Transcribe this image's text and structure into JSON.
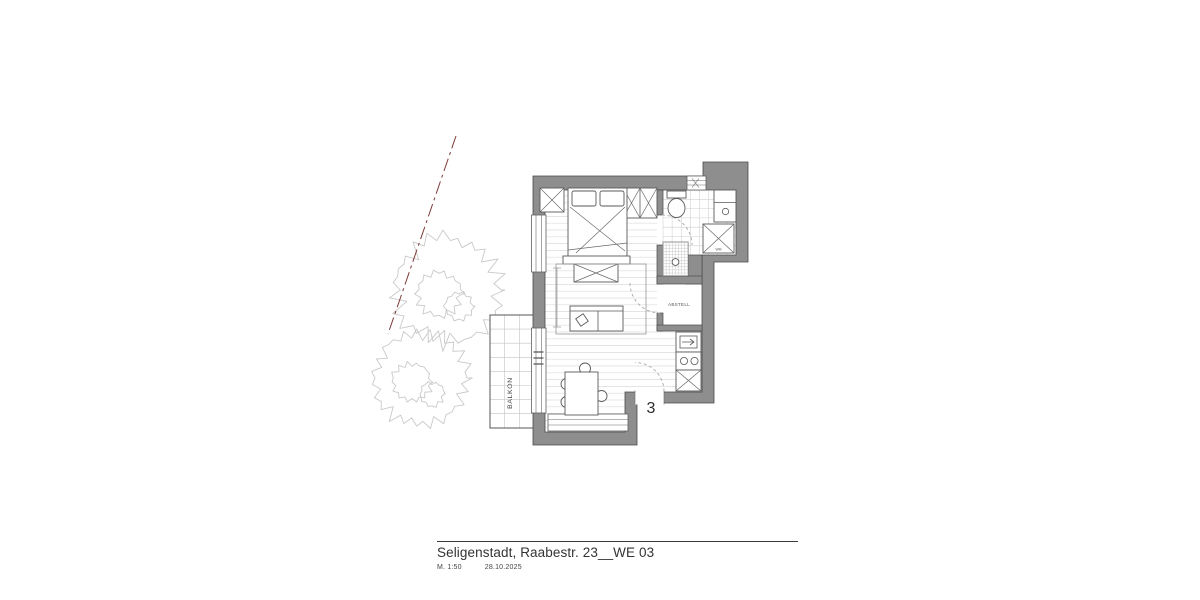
{
  "title_block": {
    "project": "Seligenstadt, Raabestr. 23__WE 03",
    "scale": "M. 1:50",
    "date": "28.10.2025"
  },
  "plan": {
    "apartment_number": "3",
    "rooms": {
      "balcony_label": "BALKON",
      "storage_label": "ABSTELL"
    },
    "fixtures": {
      "washing_machine_label": "WM"
    },
    "colors": {
      "wall_fill": "#8e8e8e",
      "wall_stroke": "#4a4a4a",
      "floor_line": "#dcdcdc",
      "tile_line": "#cfcfcf",
      "fixture_stroke": "#5a5a5a",
      "door_arc": "#a8a8a8",
      "boundary_line": "#7d3a3a",
      "tree_stroke": "#c9c9c9",
      "text": "#3c3c3c"
    }
  }
}
